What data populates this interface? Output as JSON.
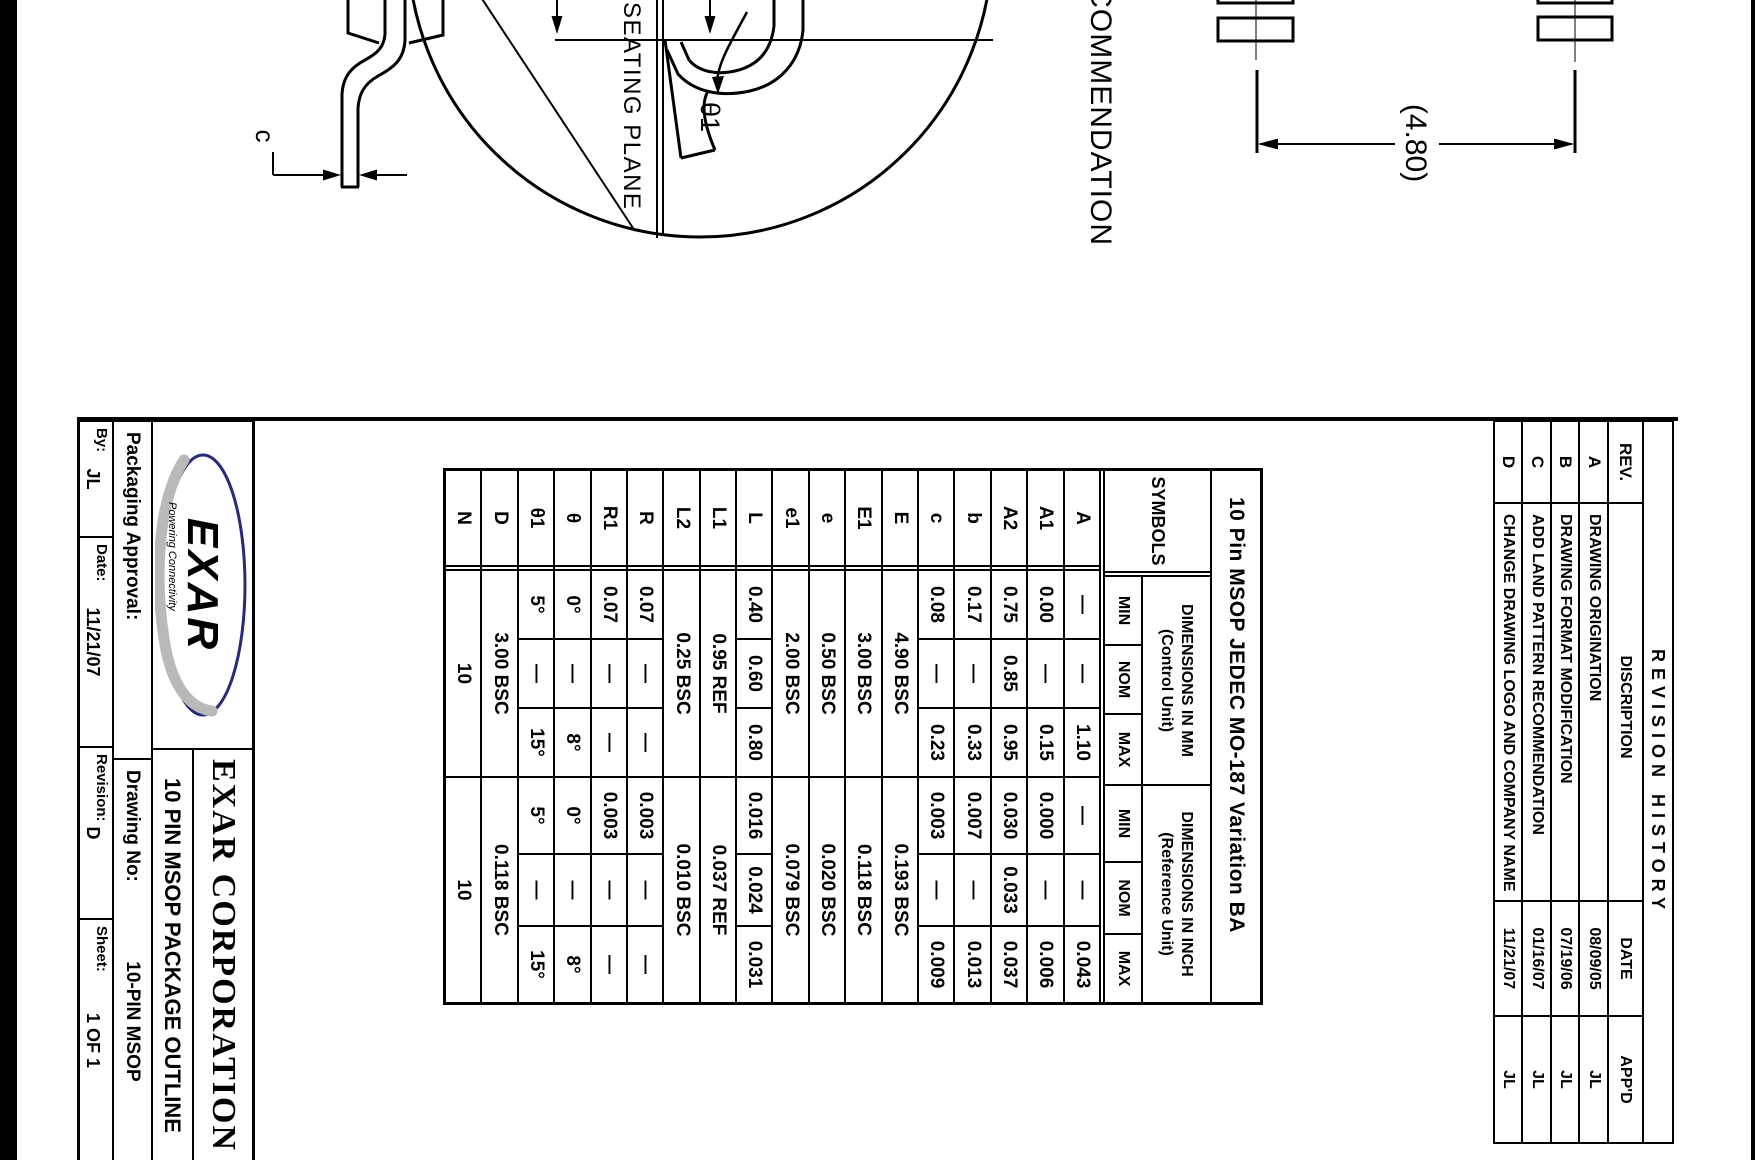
{
  "page": {
    "description": "EXAR 10-pin MSOP package outline drawing, sheet scanned rotated 90 degrees clockwise"
  },
  "revision_history": {
    "title": "REVISION HISTORY",
    "columns": [
      "REV.",
      "DISCRIPTION",
      "DATE",
      "APP'D"
    ],
    "rows": [
      {
        "rev": "A",
        "description": "DRAWING ORIGINATION",
        "date": "08/09/05",
        "appd": "JL"
      },
      {
        "rev": "B",
        "description": "DRAWING FORMAT MODIFICATION",
        "date": "07/19/06",
        "appd": "JL"
      },
      {
        "rev": "C",
        "description": "ADD LAND PATTERN RECOMMENDATION",
        "date": "01/16/07",
        "appd": "JL"
      },
      {
        "rev": "D",
        "description": "CHANGE DRAWING LOGO AND COMPANY NAME",
        "date": "11/21/07",
        "appd": "JL"
      }
    ]
  },
  "dimensions_table": {
    "title": "10 Pin MSOP JEDEC MO-187 Variation BA",
    "symbols_header": "SYMBOLS",
    "mm_header": "DIMENSIONS IN MM",
    "mm_subheader": "(Control Unit)",
    "inch_header": "DIMENSIONS IN INCH",
    "inch_subheader": "(Reference Unit)",
    "min": "MIN",
    "nom": "NOM",
    "max": "MAX",
    "rows": [
      {
        "symbol": "A",
        "mm": [
          "—",
          "—",
          "1.10"
        ],
        "inch": [
          "—",
          "—",
          "0.043"
        ]
      },
      {
        "symbol": "A1",
        "mm": [
          "0.00",
          "—",
          "0.15"
        ],
        "inch": [
          "0.000",
          "—",
          "0.006"
        ]
      },
      {
        "symbol": "A2",
        "mm": [
          "0.75",
          "0.85",
          "0.95"
        ],
        "inch": [
          "0.030",
          "0.033",
          "0.037"
        ]
      },
      {
        "symbol": "b",
        "mm": [
          "0.17",
          "—",
          "0.33"
        ],
        "inch": [
          "0.007",
          "—",
          "0.013"
        ]
      },
      {
        "symbol": "c",
        "mm": [
          "0.08",
          "—",
          "0.23"
        ],
        "inch": [
          "0.003",
          "—",
          "0.009"
        ]
      },
      {
        "symbol": "E",
        "mm": "4.90 BSC",
        "inch": "0.193 BSC"
      },
      {
        "symbol": "E1",
        "mm": "3.00 BSC",
        "inch": "0.118 BSC"
      },
      {
        "symbol": "e",
        "mm": "0.50 BSC",
        "inch": "0.020 BSC"
      },
      {
        "symbol": "e1",
        "mm": "2.00 BSC",
        "inch": "0.079 BSC"
      },
      {
        "symbol": "L",
        "mm": [
          "0.40",
          "0.60",
          "0.80"
        ],
        "inch": [
          "0.016",
          "0.024",
          "0.031"
        ]
      },
      {
        "symbol": "L1",
        "mm": "0.95 REF",
        "inch": "0.037 REF"
      },
      {
        "symbol": "L2",
        "mm": "0.25 BSC",
        "inch": "0.010 BSC"
      },
      {
        "symbol": "R",
        "mm": [
          "0.07",
          "—",
          "—"
        ],
        "inch": [
          "0.003",
          "—",
          "—"
        ]
      },
      {
        "symbol": "R1",
        "mm": [
          "0.07",
          "—",
          "—"
        ],
        "inch": [
          "0.003",
          "—",
          "—"
        ]
      },
      {
        "symbol": "θ",
        "mm": [
          "0°",
          "—",
          "8°"
        ],
        "inch": [
          "0°",
          "—",
          "8°"
        ]
      },
      {
        "symbol": "θ1",
        "mm": [
          "5°",
          "—",
          "15°"
        ],
        "inch": [
          "5°",
          "—",
          "15°"
        ]
      },
      {
        "symbol": "D",
        "mm": "3.00 BSC",
        "inch": "0.118 BSC"
      },
      {
        "symbol": "N",
        "mm": "10",
        "inch": "10"
      }
    ]
  },
  "title_block": {
    "company": "EXAR CORPORATION",
    "drawing_title": "10 PIN MSOP PACKAGE OUTLINE",
    "packaging_approval_label": "Packaging Approval:",
    "by_label": "By:",
    "by": "JL",
    "date_label": "Date:",
    "date": "11/21/07",
    "drawing_no_label": "Drawing No:",
    "drawing_no": "10-PIN MSOP",
    "revision_label": "Revision:",
    "revision": "D",
    "sheet_label": "Sheet:",
    "sheet": "1 OF 1",
    "logo": {
      "brand": "EXAR",
      "tagline": "Powering Connectivity"
    }
  },
  "drawing_labels": {
    "land_pattern_title": "LAND PATTERN RECOMMENDATION",
    "land_pattern_dim": "(4.80)",
    "seating_plane": "SEATING PLANE",
    "theta1": "θ1",
    "c_dim": "c"
  },
  "colors": {
    "ink": "#000000",
    "logo_navy": "#29297b",
    "logo_gray": "#b9b9b9",
    "logo_tagline": "#6a75a5"
  }
}
